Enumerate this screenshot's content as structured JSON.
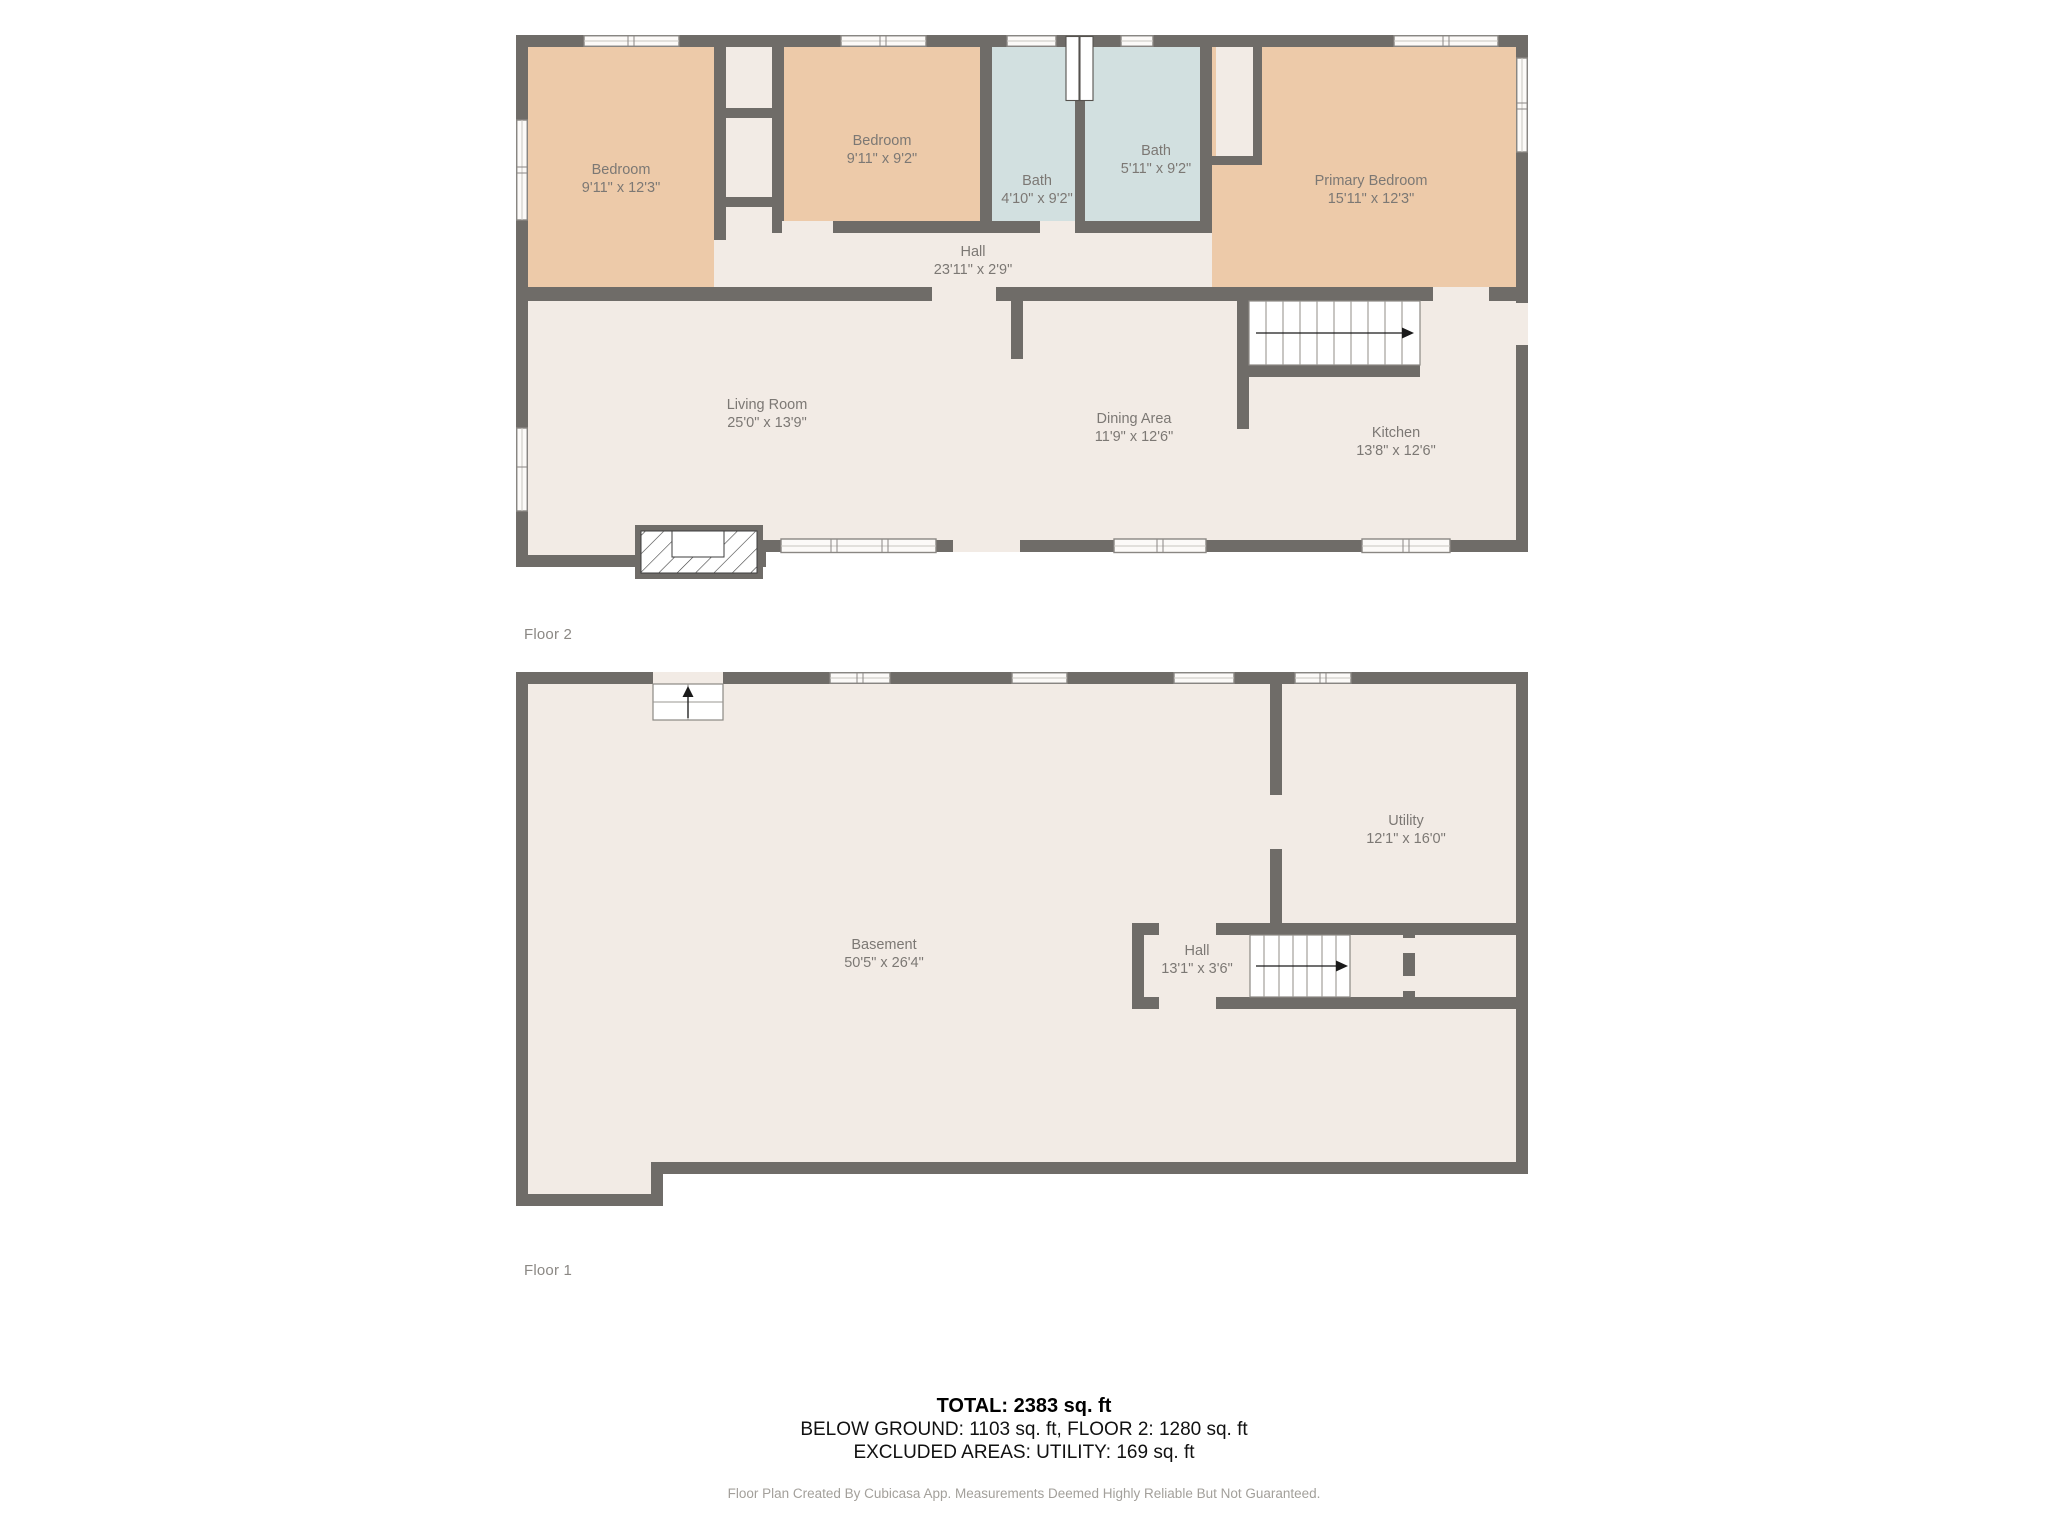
{
  "page": {
    "background": "#ffffff"
  },
  "colors": {
    "wall": "#6f6c68",
    "floor": "#f2ebe5",
    "bedroom_fill": "#edcaa9",
    "bath_fill": "#d2e0e0",
    "room_label": "#7c7874",
    "summary_text": "#000000",
    "footer_text": "#a3a09b"
  },
  "floors": [
    {
      "title": "Floor 2",
      "rooms": [
        {
          "name": "Bedroom",
          "dims": "9'11\" x 12'3\""
        },
        {
          "name": "Bedroom",
          "dims": "9'11\" x 9'2\""
        },
        {
          "name": "Bath",
          "dims": "4'10\" x 9'2\""
        },
        {
          "name": "Bath",
          "dims": "5'11\" x 9'2\""
        },
        {
          "name": "Primary Bedroom",
          "dims": "15'11\" x 12'3\""
        },
        {
          "name": "Hall",
          "dims": "23'11\" x 2'9\""
        },
        {
          "name": "Living Room",
          "dims": "25'0\" x 13'9\""
        },
        {
          "name": "Dining Area",
          "dims": "11'9\" x 12'6\""
        },
        {
          "name": "Kitchen",
          "dims": "13'8\" x 12'6\""
        }
      ]
    },
    {
      "title": "Floor 1",
      "rooms": [
        {
          "name": "Basement",
          "dims": "50'5\" x 26'4\""
        },
        {
          "name": "Utility",
          "dims": "12'1\" x 16'0\""
        },
        {
          "name": "Hall",
          "dims": "13'1\" x 3'6\""
        }
      ]
    }
  ],
  "summary": {
    "total": "TOTAL: 2383 sq. ft",
    "breakdown": "BELOW GROUND: 1103 sq. ft, FLOOR 2: 1280 sq. ft",
    "excluded": "EXCLUDED AREAS: UTILITY: 169 sq. ft"
  },
  "footer": "Floor Plan Created By Cubicasa App. Measurements Deemed Highly Reliable But Not Guaranteed."
}
